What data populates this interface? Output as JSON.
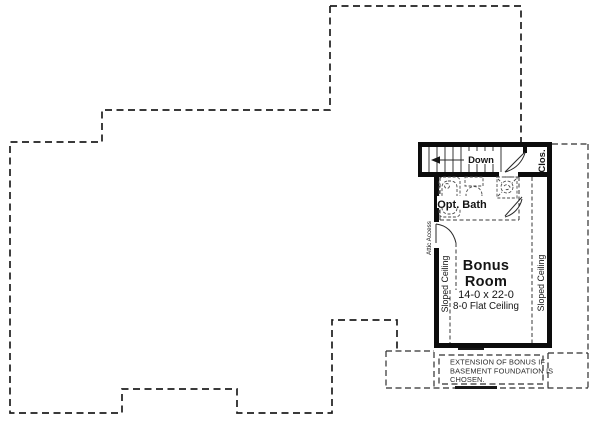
{
  "plan": {
    "labels": {
      "down": "Down",
      "closet": "Clos.",
      "opt_bath": "Opt. Bath",
      "attic_access": "Attic Access",
      "sloped_ceiling_left": "Sloped Ceiling",
      "sloped_ceiling_right": "Sloped Ceiling",
      "bonus_line1": "Bonus",
      "bonus_line2": "Room",
      "bonus_dims": "14-0 x 22-0",
      "bonus_ceiling": "8-0 Flat Ceiling"
    },
    "extension_note": {
      "line1": "EXTENSION OF BONUS IF",
      "line2": "BASEMENT FOUNDATION IS",
      "line3": "CHOSEN."
    },
    "colors": {
      "ink": "#1e1e1e",
      "wall": "#0c0c0c",
      "background": "#ffffff"
    }
  }
}
